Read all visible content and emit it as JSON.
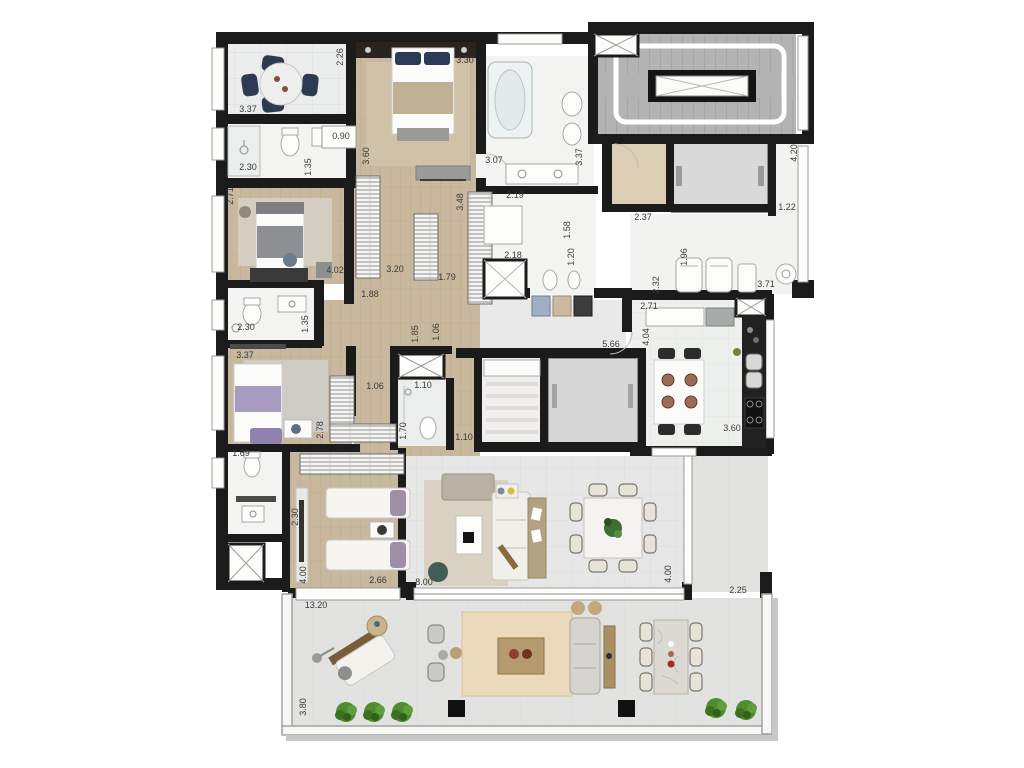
{
  "title": "Apartment floor plan with terrace",
  "colors": {
    "wall": "#1b1b1b",
    "wood_floor": "#c8b89e",
    "white_tile": "#f3f3f1",
    "gray_tile": "#e6e7e6",
    "terrace_tile": "#e2e3e1",
    "stair_gray": "#b3b3b3",
    "elevator_gray": "#d8d9d8",
    "lobby_beige": "#dbceb3",
    "rug_tan": "#cfc2a7",
    "navy_chair": "#2e3a52",
    "lavender_bed": "#a89bc2",
    "teal_pouf": "#415e56",
    "plant_green": "#4e8c31",
    "counter_black": "#212121",
    "outdoor_wood": "#b09468"
  },
  "dimension_labels": [
    {
      "text": "2.26",
      "x": 343,
      "y": 57,
      "rot": -90
    },
    {
      "text": "3.30",
      "x": 465,
      "y": 63,
      "rot": 0
    },
    {
      "text": "3.37",
      "x": 248,
      "y": 112,
      "rot": 0
    },
    {
      "text": "0.90",
      "x": 341,
      "y": 139,
      "rot": 0
    },
    {
      "text": "3.60",
      "x": 369,
      "y": 156,
      "rot": -90
    },
    {
      "text": "2.30",
      "x": 248,
      "y": 170,
      "rot": 0
    },
    {
      "text": "1.35",
      "x": 311,
      "y": 167,
      "rot": -90
    },
    {
      "text": "2.71",
      "x": 233,
      "y": 196,
      "rot": -90
    },
    {
      "text": "3.07",
      "x": 494,
      "y": 163,
      "rot": 0
    },
    {
      "text": "3.48",
      "x": 463,
      "y": 202,
      "rot": -90
    },
    {
      "text": "3.37",
      "x": 582,
      "y": 157,
      "rot": -90
    },
    {
      "text": "2.19",
      "x": 515,
      "y": 198,
      "rot": 0
    },
    {
      "text": "1.58",
      "x": 570,
      "y": 230,
      "rot": -90
    },
    {
      "text": "2.37",
      "x": 643,
      "y": 220,
      "rot": 0
    },
    {
      "text": "1.22",
      "x": 787,
      "y": 210,
      "rot": 0
    },
    {
      "text": "4.20",
      "x": 797,
      "y": 153,
      "rot": -90
    },
    {
      "text": "3.71",
      "x": 766,
      "y": 287,
      "rot": 0
    },
    {
      "text": "1.96",
      "x": 687,
      "y": 257,
      "rot": -90
    },
    {
      "text": "2.32",
      "x": 659,
      "y": 285,
      "rot": -90
    },
    {
      "text": "2.71",
      "x": 649,
      "y": 309,
      "rot": 0
    },
    {
      "text": "4.04",
      "x": 649,
      "y": 337,
      "rot": -90
    },
    {
      "text": "5.66",
      "x": 611,
      "y": 347,
      "rot": 0
    },
    {
      "text": "3.60",
      "x": 732,
      "y": 431,
      "rot": 0
    },
    {
      "text": "4.02",
      "x": 335,
      "y": 273,
      "rot": 0
    },
    {
      "text": "3.20",
      "x": 395,
      "y": 272,
      "rot": 0
    },
    {
      "text": "1.88",
      "x": 370,
      "y": 297,
      "rot": 0
    },
    {
      "text": "1.79",
      "x": 447,
      "y": 280,
      "rot": 0
    },
    {
      "text": "2.30",
      "x": 246,
      "y": 330,
      "rot": 0
    },
    {
      "text": "1.35",
      "x": 308,
      "y": 324,
      "rot": -90
    },
    {
      "text": "3.37",
      "x": 245,
      "y": 358,
      "rot": 0
    },
    {
      "text": "1.06",
      "x": 375,
      "y": 389,
      "rot": 0
    },
    {
      "text": "1.85",
      "x": 418,
      "y": 334,
      "rot": -90
    },
    {
      "text": "1.06",
      "x": 439,
      "y": 332,
      "rot": -90
    },
    {
      "text": "1.10",
      "x": 423,
      "y": 388,
      "rot": 0
    },
    {
      "text": "1.70",
      "x": 406,
      "y": 431,
      "rot": -90
    },
    {
      "text": "1.10",
      "x": 464,
      "y": 440,
      "rot": 0
    },
    {
      "text": "2.18",
      "x": 513,
      "y": 258,
      "rot": 0
    },
    {
      "text": "1.20",
      "x": 574,
      "y": 257,
      "rot": -90
    },
    {
      "text": "2.78",
      "x": 323,
      "y": 430,
      "rot": -90
    },
    {
      "text": "1.69",
      "x": 241,
      "y": 456,
      "rot": 0
    },
    {
      "text": "2.30",
      "x": 298,
      "y": 517,
      "rot": -90
    },
    {
      "text": "4.00",
      "x": 306,
      "y": 575,
      "rot": -90
    },
    {
      "text": "2.66",
      "x": 378,
      "y": 583,
      "rot": 0
    },
    {
      "text": "8.00",
      "x": 424,
      "y": 585,
      "rot": 0
    },
    {
      "text": "4.00",
      "x": 671,
      "y": 574,
      "rot": -90
    },
    {
      "text": "2.25",
      "x": 738,
      "y": 593,
      "rot": 0
    },
    {
      "text": "13.20",
      "x": 316,
      "y": 608,
      "rot": 0
    },
    {
      "text": "3.80",
      "x": 306,
      "y": 707,
      "rot": -90
    }
  ]
}
